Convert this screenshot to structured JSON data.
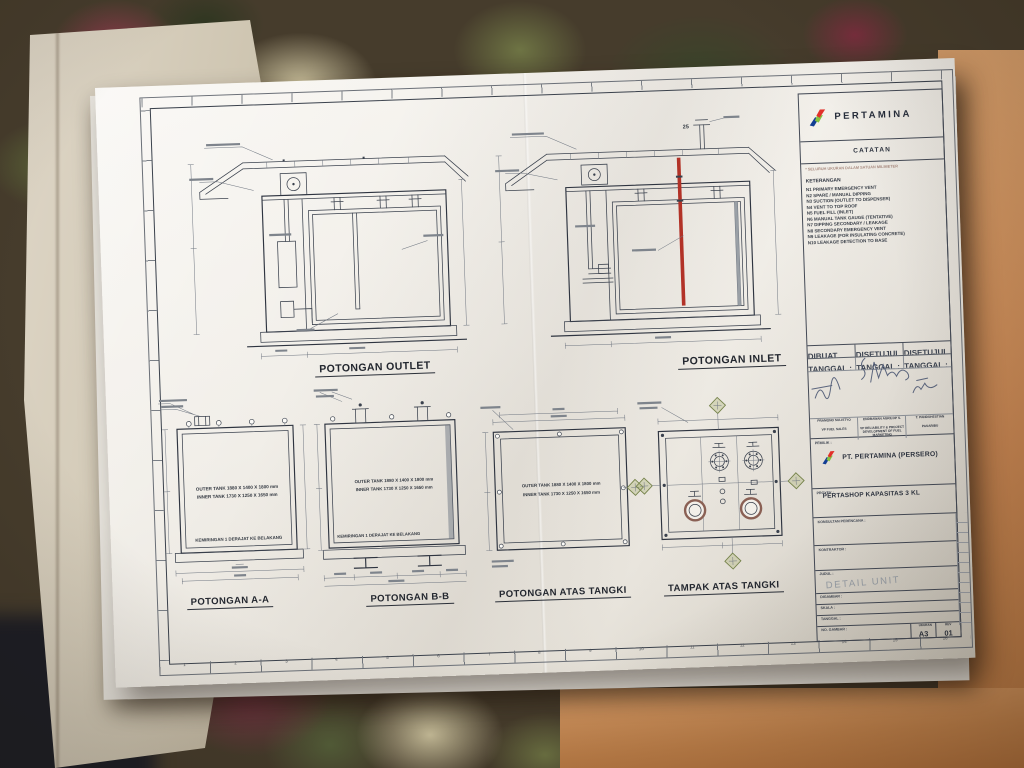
{
  "sheet": {
    "brand": "PERTAMINA",
    "legend": {
      "catatan_title": "CATATAN",
      "units_note": "* SELURUH UKURAN DALAM SATUAN MILIMETER",
      "keterangan_title": "KETERANGAN",
      "notes": [
        "N1   PRIMARY EMERGENCY VENT",
        "N2   SPARE / MANUAL DIPPING",
        "N3   SUCTION (OUTLET TO DISPENSER)",
        "N4   VENT TO TOP ROOF",
        "N5   FUEL FILL (INLET)",
        "N6   MANUAL TANK GAUGE (TENTATIVE)",
        "N7   DIPPING SECONDARY / LEAKAGE",
        "N8   SECONDARY EMERGENCY VENT",
        "N9   LEAKAGE (FOR INSULATING CONCRETE)",
        "N10  LEAKAGE DETECTION TO BASE"
      ]
    },
    "approval": {
      "headers": [
        "DIBUAT",
        "DISETUJUI",
        "DISETUJUI"
      ],
      "date_label": "TANGGAL :",
      "signers": [
        {
          "name": "PRAMONO SULISTYO",
          "role": "VP FUEL SALES"
        },
        {
          "name": "ENDRAWAN AGRILOP S.",
          "role": "VP RELIABILITY & PROJECT DEVELOPMENT OF FUEL MARKETING"
        },
        {
          "name": "T. PANDUHESTIAN",
          "role": "PASARIBU"
        }
      ]
    },
    "titleblock": {
      "pemilik_label": "PEMILIK :",
      "company": "PT. PERTAMINA (PERSERO)",
      "proyek_label": "PROYEK :",
      "project": "PERTASHOP KAPASITAS 3 KL",
      "konsultan_label": "KONSULTAN PERENCANA :",
      "kontraktor_label": "KONTRAKTOR :",
      "judul_label": "JUDUL :",
      "judul_value": "DETAIL UNIT",
      "digambar_label": "DIGAMBAR :",
      "skala_label": "SKALA :",
      "tanggal_label": "TANGGAL :",
      "no_gambar_label": "NO. GAMBAR :",
      "ukuran_label": "UKURAN",
      "ukuran_value": "A3",
      "rev_label": "REV",
      "rev_value": "01"
    },
    "drawings": {
      "outlet_label": "POTONGAN OUTLET",
      "inlet_label": "POTONGAN INLET",
      "aa_label": "POTONGAN A-A",
      "bb_label": "POTONGAN B-B",
      "atas_label": "POTONGAN ATAS TANGKI",
      "tampak_label": "TAMPAK ATAS TANGKI",
      "outer_tank": "OUTER TANK 1880 X 1400 X 1800 mm",
      "inner_tank": "INNER TANK 1730 X 1250 X 1650 mm",
      "slope_note": "KEMIRINGAN 1 DERAJAT KE BELAKANG",
      "vent_dim": "25"
    },
    "grid_numbers": [
      "1",
      "2",
      "3",
      "4",
      "5",
      "6",
      "7",
      "8",
      "9",
      "10",
      "11",
      "12",
      "13",
      "14",
      "15",
      "16"
    ]
  },
  "colors": {
    "pertamina_blue": "#123e93",
    "pertamina_green": "#84c341",
    "pertamina_red": "#e2312a",
    "fill_pipe_red": "#b23227",
    "section_marker_olive": "#76834b",
    "paper": "#f1eee8",
    "table_wood": "#c58451"
  }
}
